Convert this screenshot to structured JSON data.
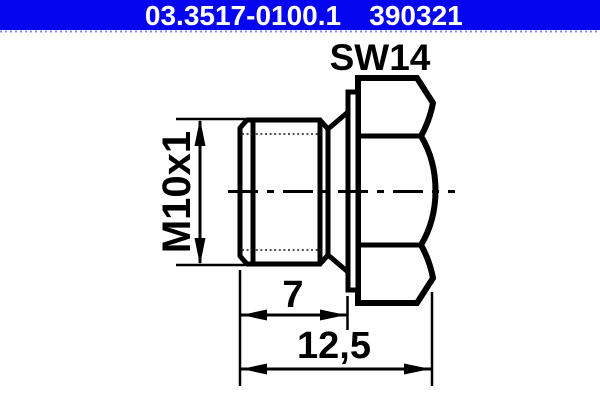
{
  "header": {
    "part_number": "03.3517-0100.1",
    "catalog_number": "390321",
    "bg_color": "#0505f0",
    "text_color": "#ffffff"
  },
  "drawing": {
    "type": "technical-part-drawing",
    "part": "screw-plug-with-hex-head",
    "wrench_size_label": "SW14",
    "thread_label": "M10x1",
    "thread_length_label": "7",
    "overall_length_label": "12,5",
    "line_color": "#000000",
    "bg_color": "#ffffff"
  }
}
